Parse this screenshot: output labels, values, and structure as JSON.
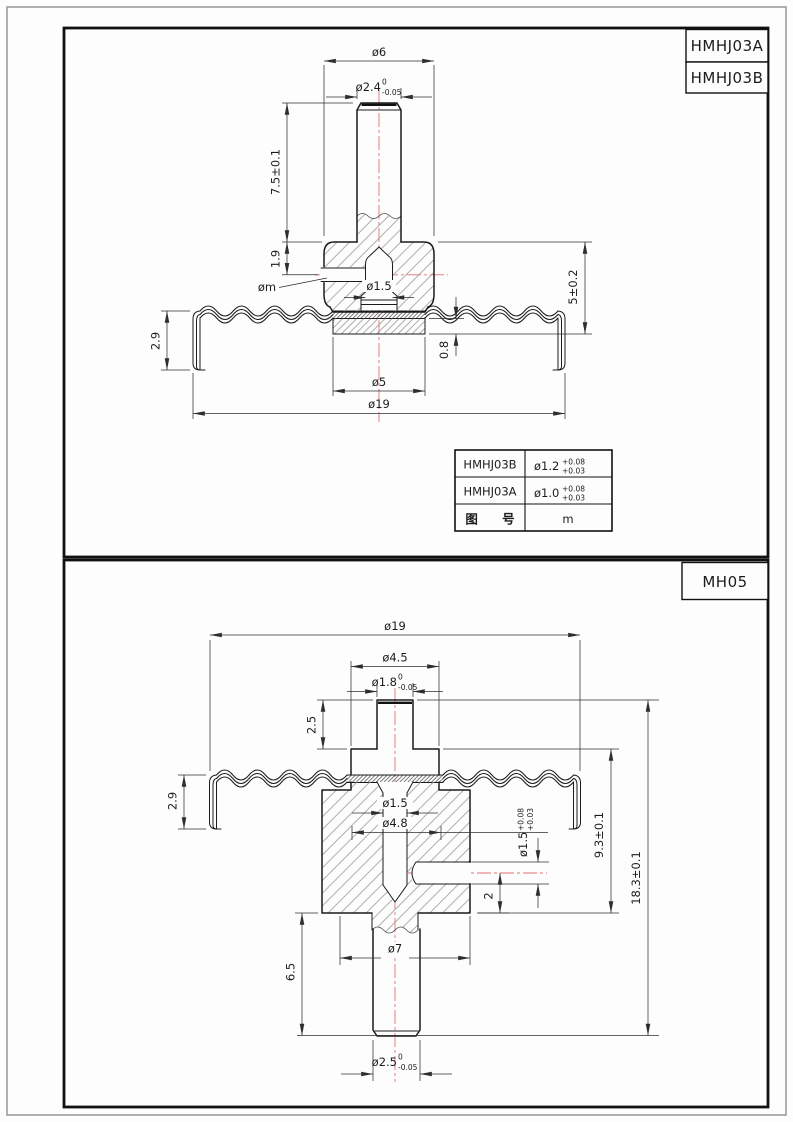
{
  "sheet": {
    "top_panel": {
      "titles": [
        "HMHJ03A",
        "HMHJ03B"
      ],
      "dims": {
        "dia6": "ø6",
        "dia24": "ø2.4",
        "dia24_sup": "0",
        "dia24_sub": "-0.05",
        "len75": "7.5±0.1",
        "len19": "1.9",
        "dm": "øm",
        "dia15": "ø1.5",
        "len5": "5±0.2",
        "len29": "2.9",
        "len08": "0.8",
        "dia5": "ø5",
        "dia19": "ø19"
      },
      "table": {
        "rows": [
          {
            "model": "HMHJ03B",
            "value": "ø1.2",
            "tol_upper": "+0.08",
            "tol_lower": "+0.03"
          },
          {
            "model": "HMHJ03A",
            "value": "ø1.0",
            "tol_upper": "+0.08",
            "tol_lower": "+0.03"
          },
          {
            "model": "图 号",
            "value": "m"
          }
        ]
      }
    },
    "bottom_panel": {
      "titles": [
        "MH05"
      ],
      "dims": {
        "dia19": "ø19",
        "dia45": "ø4.5",
        "dia18": "ø1.8",
        "dia18_sup": "0",
        "dia18_sub": "-0.05",
        "len25": "2.5",
        "len29": "2.9",
        "dia15": "ø1.5",
        "dia48": "ø4.8",
        "dia15s": "ø1.5",
        "dia15s_sup": "+0.08",
        "dia15s_sub": "+0.03",
        "len2": "2",
        "len93": "9.3±0.1",
        "len183": "18.3±0.1",
        "len65": "6.5",
        "dia7": "ø7",
        "dia25": "ø2.5",
        "dia25_sup": "0",
        "dia25_sub": "-0.05"
      }
    },
    "colors": {
      "centerline": "#e3716f",
      "outline": "#1b1b1b",
      "dimension": "#2e2e2e"
    }
  }
}
